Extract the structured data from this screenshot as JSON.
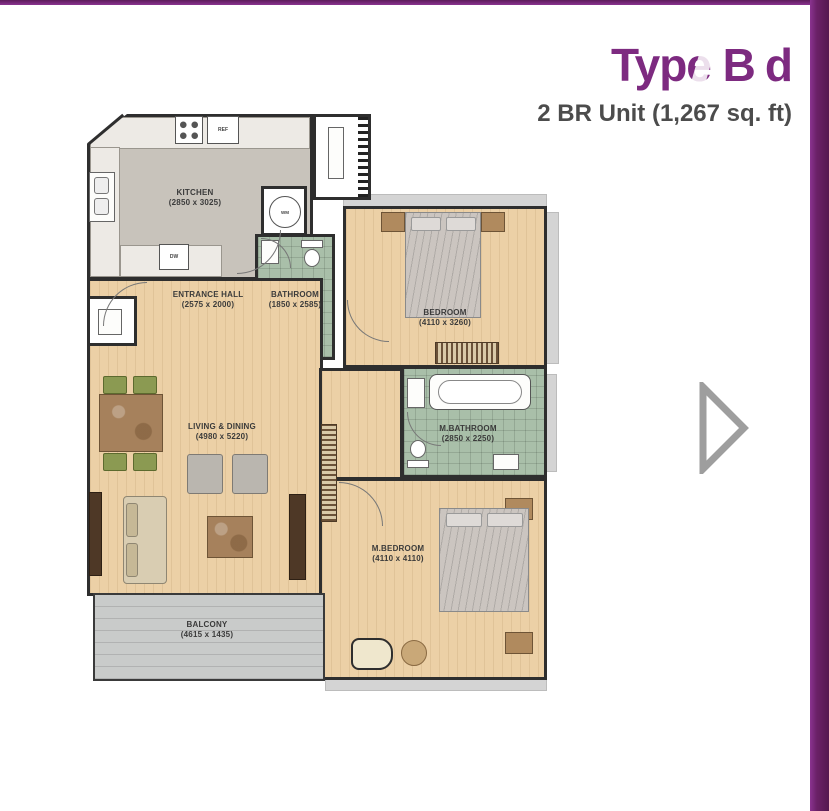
{
  "header": {
    "title": "Type B",
    "title_ghost": "d",
    "subtitle": "2 BR Unit (1,267 sq. ft)"
  },
  "floorplan": {
    "rooms": [
      {
        "label": "KITCHEN",
        "dims": "(2850 x 3025)"
      },
      {
        "label": "BATHROOM",
        "dims": "(1850 x 2585)"
      },
      {
        "label": "BEDROOM",
        "dims": "(4110 x 3260)"
      },
      {
        "label": "ENTRANCE HALL",
        "dims": "(2575 x 2000)"
      },
      {
        "label": "LIVING & DINING",
        "dims": "(4980 x 5220)"
      },
      {
        "label": "M.BATHROOM",
        "dims": "(2850 x 2250)"
      },
      {
        "label": "M.BEDROOM",
        "dims": "(4110 x 4110)"
      },
      {
        "label": "BALCONY",
        "dims": "(4615 x 1435)"
      }
    ],
    "appliances": {
      "ref": "REF",
      "dw": "DW",
      "wm": "WM"
    }
  },
  "colors": {
    "accent_purple": "#7d2a80",
    "subtitle_gray": "#4c4c4c",
    "arrow_gray": "#9e9e9e"
  }
}
